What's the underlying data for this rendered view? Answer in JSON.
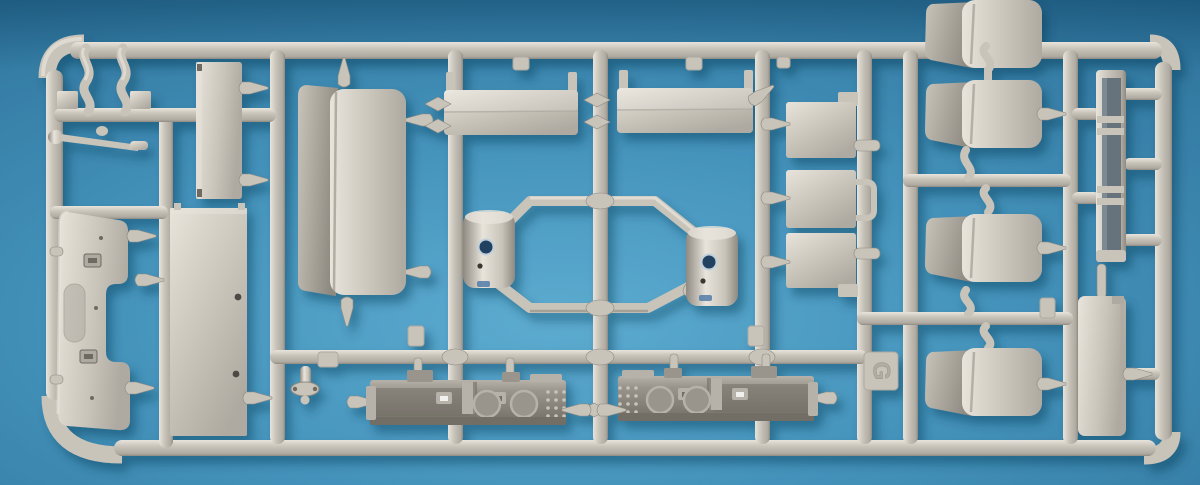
{
  "meta": {
    "description": "Photograph of a light gray injection-molded model kit sprue (parts tree) lying on a textured blue background",
    "sprue_letter": "G"
  },
  "colors": {
    "background": "#2e86b3",
    "background_dark": "#15618d",
    "background_light": "#4aa2cb",
    "plastic_highlight": "#e8e4db",
    "plastic_base": "#c9c4ba",
    "plastic_mid": "#aeaaa1",
    "plastic_shadow": "#8e8a81",
    "plastic_dark": "#6e6a62",
    "dashboard_light": "#b6b2a9",
    "dashboard_base": "#9a958c",
    "dashboard_dark": "#726e66",
    "channel_dark": "#66737d",
    "lens_blue": "#23405f",
    "detail_blue": "#4a76a5",
    "cast_shadow": "#0a3552"
  }
}
